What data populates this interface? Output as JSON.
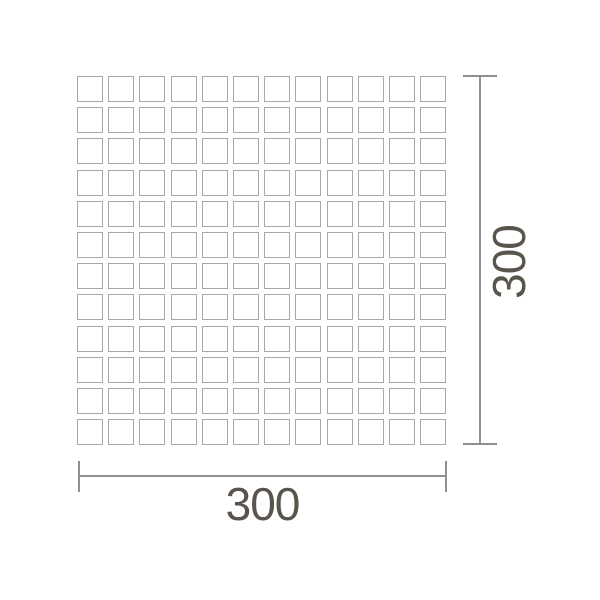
{
  "diagram": {
    "grid": {
      "rows": 12,
      "cols": 12
    },
    "width_dimension": {
      "label": "300"
    },
    "height_dimension": {
      "label": "300"
    },
    "colors": {
      "background": "#ffffff",
      "tile_border": "#a8a8a8",
      "dimension_line": "#8f8f8f",
      "label_text": "#59554d"
    }
  }
}
